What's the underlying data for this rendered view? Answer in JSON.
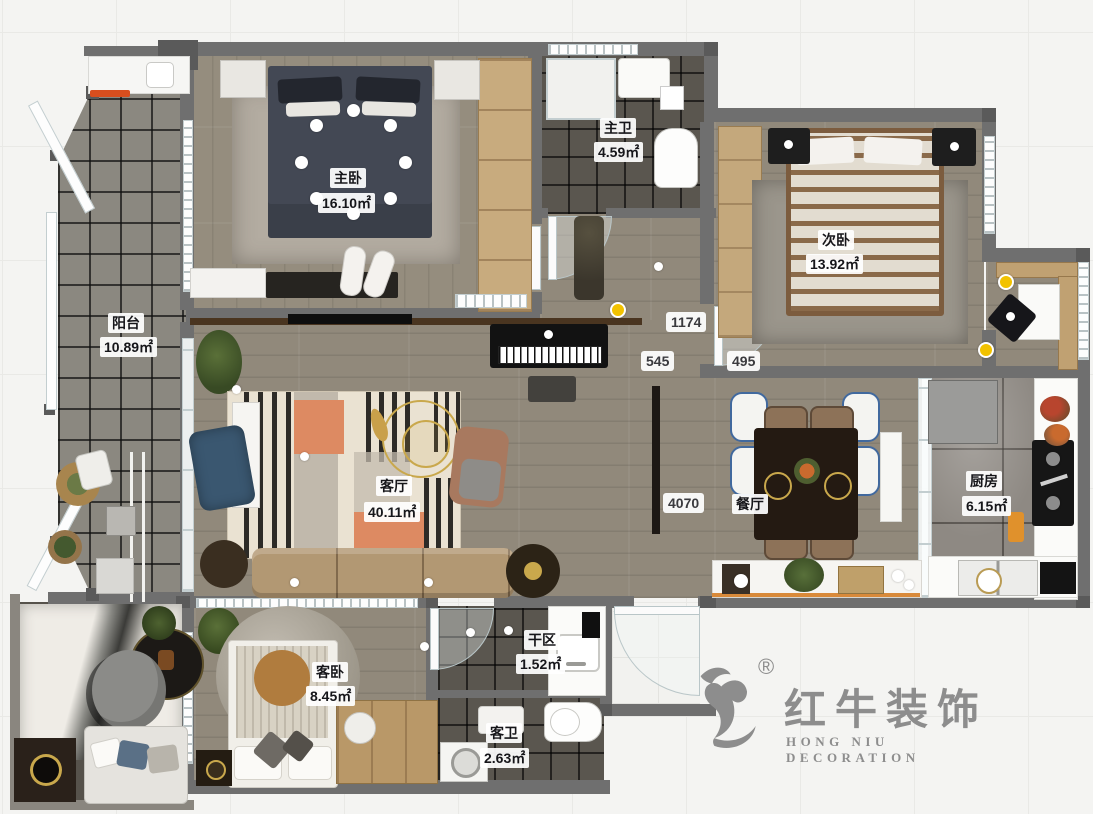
{
  "rooms": [
    {
      "id": "master-bedroom",
      "name": "主卧",
      "area": "16.10㎡"
    },
    {
      "id": "master-bath",
      "name": "主卫",
      "area": "4.59㎡"
    },
    {
      "id": "second-bedroom",
      "name": "次卧",
      "area": "13.92㎡"
    },
    {
      "id": "balcony",
      "name": "阳台",
      "area": "10.89㎡"
    },
    {
      "id": "living-room",
      "name": "客厅",
      "area": "40.11㎡"
    },
    {
      "id": "dining-room",
      "name": "餐厅",
      "area": ""
    },
    {
      "id": "kitchen",
      "name": "厨房",
      "area": "6.15㎡"
    },
    {
      "id": "guest-bedroom",
      "name": "客卧",
      "area": "8.45㎡"
    },
    {
      "id": "dry-area",
      "name": "干区",
      "area": "1.52㎡"
    },
    {
      "id": "guest-bath",
      "name": "客卫",
      "area": "2.63㎡"
    }
  ],
  "dimensions": [
    {
      "value": "1174"
    },
    {
      "value": "545"
    },
    {
      "value": "495"
    },
    {
      "value": "4070"
    }
  ],
  "logo": {
    "brand_cn": "红牛装饰",
    "brand_en": "HONG NIU DECORATION",
    "registered_mark": "®"
  },
  "palette": {
    "wall": "#6f6f6f",
    "wood_floor": "#91897b",
    "dark_tile": "#5a564f",
    "accent_orange": "#dd8a62",
    "highlight_yellow": "#f2c200",
    "logo_gray": "#8d8d8d"
  }
}
